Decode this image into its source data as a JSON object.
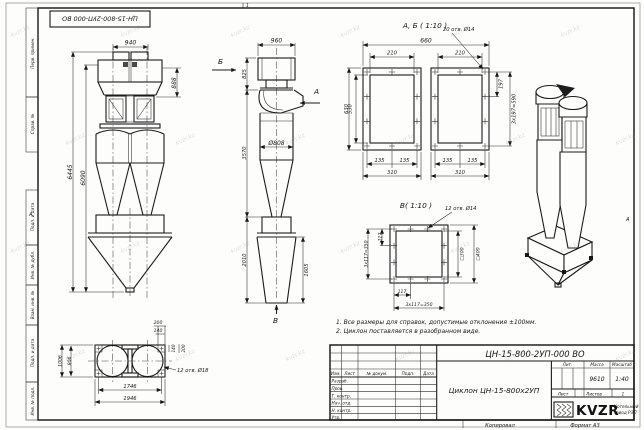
{
  "sheet": {
    "stamp_designation": "ЦН-15-800-2УП-000 ВО",
    "zone_letter_left": "А",
    "zone_letter_right": "А",
    "fold_mark": "1",
    "watermark": "kvzr.kz"
  },
  "margin_labels": {
    "top": [
      "Перв. примен.",
      "Справ. №"
    ],
    "bottom": [
      "Подп. и дата",
      "Инв. № дубл.",
      "Взам. инв. №",
      "Подп. и дата",
      "Инв. № подл."
    ]
  },
  "front_view": {
    "dim_940": "940",
    "dim_888": "888",
    "dim_6445": "6445",
    "dim_6090": "6090"
  },
  "side_view": {
    "dim_960": "960",
    "dim_825": "825",
    "dim_3570": "3570",
    "dim_d808": "Ø808",
    "dim_2010": "2010",
    "dim_1605": "1605",
    "arrow_a": "А",
    "arrow_b": "Б",
    "arrow_v": "В"
  },
  "detail_ab": {
    "title": "А, Б ( 1:10 )",
    "note": "20 отв. Ø14",
    "dim_660": "660",
    "dim_210a": "210",
    "dim_210b": "210",
    "dim_630": "630",
    "dim_530": "530",
    "dim_197": "197",
    "dim_590": "3х197=590",
    "dim_135a": "135",
    "dim_135b": "135",
    "dim_135c": "135",
    "dim_135d": "135",
    "dim_310a": "310",
    "dim_310b": "310"
  },
  "detail_v": {
    "title": "В( 1:10 )",
    "note": "12 отв. Ø14",
    "dim_117_left": "117",
    "dim_350_left": "3х117=350",
    "dim_117_bottom": "117",
    "dim_350_bottom": "3х117=350",
    "dim_sq300": "□300",
    "dim_sq400": "□400"
  },
  "bottom_view": {
    "note": "12 отв. Ø18",
    "dim_200_top": "200",
    "dim_140_top": "140",
    "dim_140_right": "140",
    "dim_200_right": "200",
    "dim_1006": "1006",
    "dim_806": "806",
    "dim_1746": "1746",
    "dim_1946": "1946"
  },
  "notes": {
    "line1": "1. Все размеры для справок, допустимые отклонения ±100мм.",
    "line2": "2. Циклон поставляется в разобранном виде."
  },
  "title_block": {
    "designation": "ЦН-15-800-2УП-000 ВО",
    "name": "Циклон ЦН-15-800х2УП",
    "columns": [
      "Изм.",
      "Лист",
      "№ докум.",
      "Подп.",
      "Дата"
    ],
    "rows": [
      "Разраб.",
      "Пров.",
      "Т. контр.",
      "Нач. отд.",
      "Н. контр.",
      "Утв."
    ],
    "lit": "Лит.",
    "massa": "Масса",
    "masshtab": "Масштаб",
    "massa_value": "9610",
    "masshtab_value": "1:40",
    "list": "Лист",
    "listov": "Листов",
    "listov_value": "1",
    "logo": "KVZR",
    "company_line1": "Котельный",
    "company_line2": "завод РЭП",
    "kopiroval": "Копировал",
    "format": "Формат А3"
  }
}
